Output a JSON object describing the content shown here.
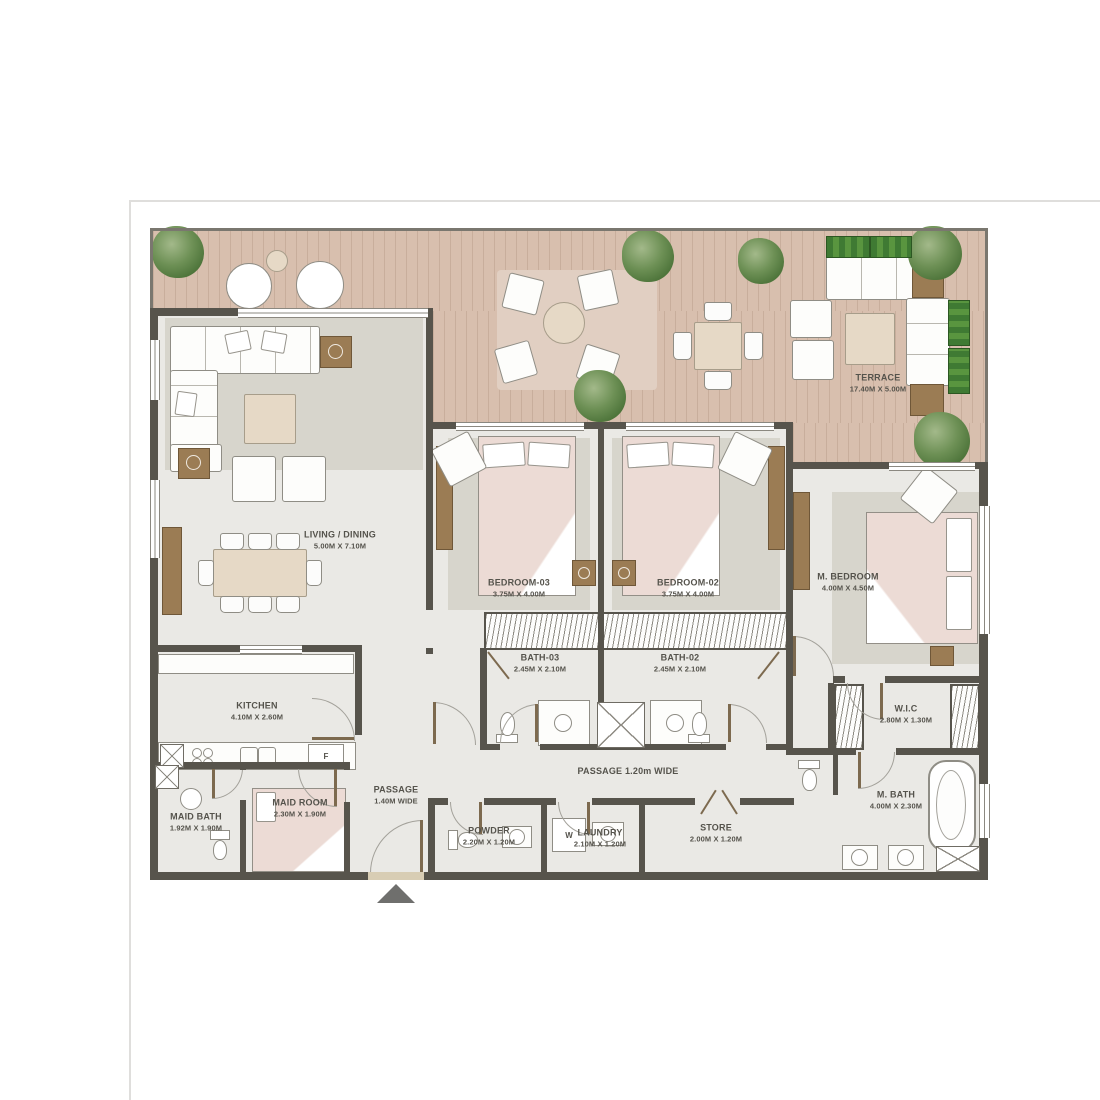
{
  "rooms": {
    "terrace": {
      "name": "TERRACE",
      "dims": "17.40M X 5.00M"
    },
    "living_dining": {
      "name": "LIVING / DINING",
      "dims": "5.00M X 7.10M"
    },
    "bedroom_03": {
      "name": "BEDROOM-03",
      "dims": "3.75M X 4.00M"
    },
    "bedroom_02": {
      "name": "BEDROOM-02",
      "dims": "3.75M X 4.00M"
    },
    "m_bedroom": {
      "name": "M. BEDROOM",
      "dims": "4.00M X 4.50M"
    },
    "bath_03": {
      "name": "BATH-03",
      "dims": "2.45M X 2.10M"
    },
    "bath_02": {
      "name": "BATH-02",
      "dims": "2.45M X 2.10M"
    },
    "kitchen": {
      "name": "KITCHEN",
      "dims": "4.10M X 2.60M"
    },
    "maid_bath": {
      "name": "MAID BATH",
      "dims": "1.92M X 1.90M"
    },
    "maid_room": {
      "name": "MAID ROOM",
      "dims": "2.30M X 1.90M"
    },
    "passage_main": {
      "name": "PASSAGE",
      "dims": "1.40M WIDE"
    },
    "passage_bedrooms": {
      "name": "PASSAGE 1.20m WIDE"
    },
    "powder": {
      "name": "POWDER",
      "dims": "2.20M X 1.20M"
    },
    "laundry": {
      "name": "LAUNDRY",
      "dims": "2.10M X 1.20M"
    },
    "store": {
      "name": "STORE",
      "dims": "2.00M X 1.20M"
    },
    "wic": {
      "name": "W.I.C",
      "dims": "2.80M X 1.30M"
    },
    "m_bath": {
      "name": "M. BATH",
      "dims": "4.00M X 2.30M"
    }
  },
  "appliances": {
    "washer": "W",
    "fridge": "F"
  },
  "icons": {
    "entrance_arrow": "up-triangle"
  },
  "colors": {
    "wall": "#57544c",
    "terrace_wood": "#d8bfae",
    "tree_green": "#4c7339",
    "planter_green": "#3f7a33",
    "bed_pink": "#ecdbd5",
    "floor": "#eae9e5"
  }
}
